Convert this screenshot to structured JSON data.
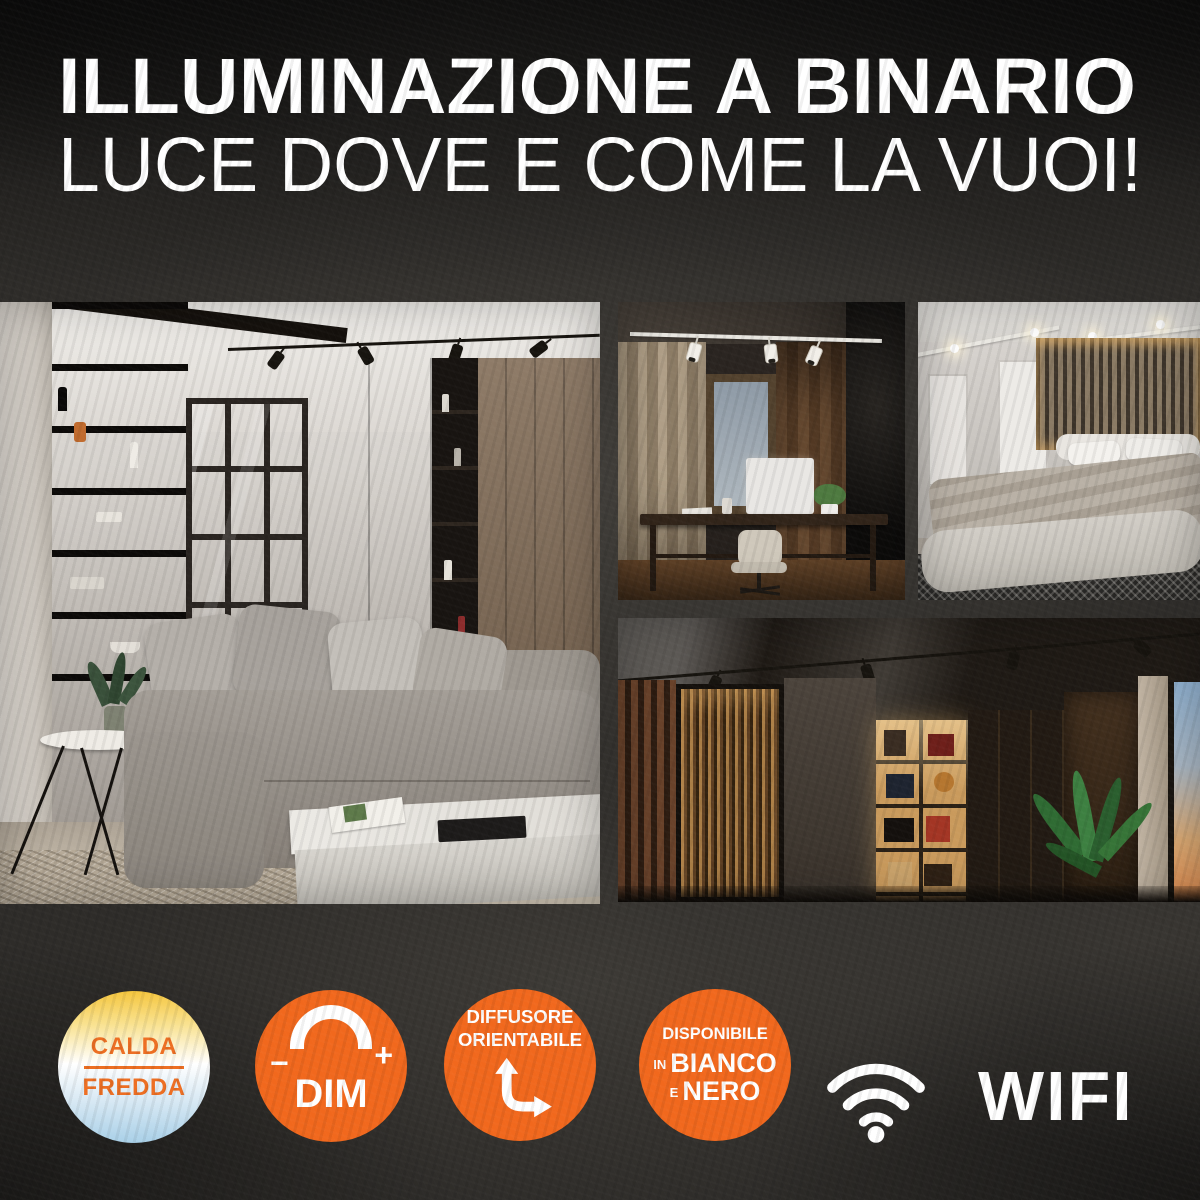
{
  "header": {
    "title_line1": "ILLUMINAZIONE A BINARIO",
    "title_line2": "LUCE DOVE E COME LA VUOI!"
  },
  "gallery": {
    "photos": [
      {
        "id": "living-room",
        "description": "soggiorno con binario nero di faretti a soffitto"
      },
      {
        "id": "home-office",
        "description": "studio con binario bianco di faretti"
      },
      {
        "id": "bedroom",
        "description": "camera da letto con faretti a binario bianchi"
      },
      {
        "id": "library-hallway",
        "description": "zona libreria con binario nero di faretti"
      }
    ]
  },
  "features": {
    "color_temperature": {
      "line1": "CALDA",
      "line2": "FREDDA"
    },
    "dimmer": {
      "minus": "−",
      "plus": "+",
      "label": "DIM"
    },
    "adjustable": {
      "line1": "DIFFUSORE",
      "line2": "ORIENTABILE"
    },
    "variants": {
      "line1": "DISPONIBILE",
      "line2_prefix": "IN",
      "line2": "BIANCO",
      "line3_prefix": "E",
      "line3": "NERO"
    },
    "wifi": {
      "label": "WIFI"
    }
  },
  "colors": {
    "accent_orange": "#F1681D",
    "badge_text_orange": "#ED6E22",
    "gradient_warm_yellow": "#F5C63E",
    "gradient_cool_blue": "#A9D0E8",
    "text_white": "#FFFFFF",
    "background_concrete": "#2E2C29"
  }
}
